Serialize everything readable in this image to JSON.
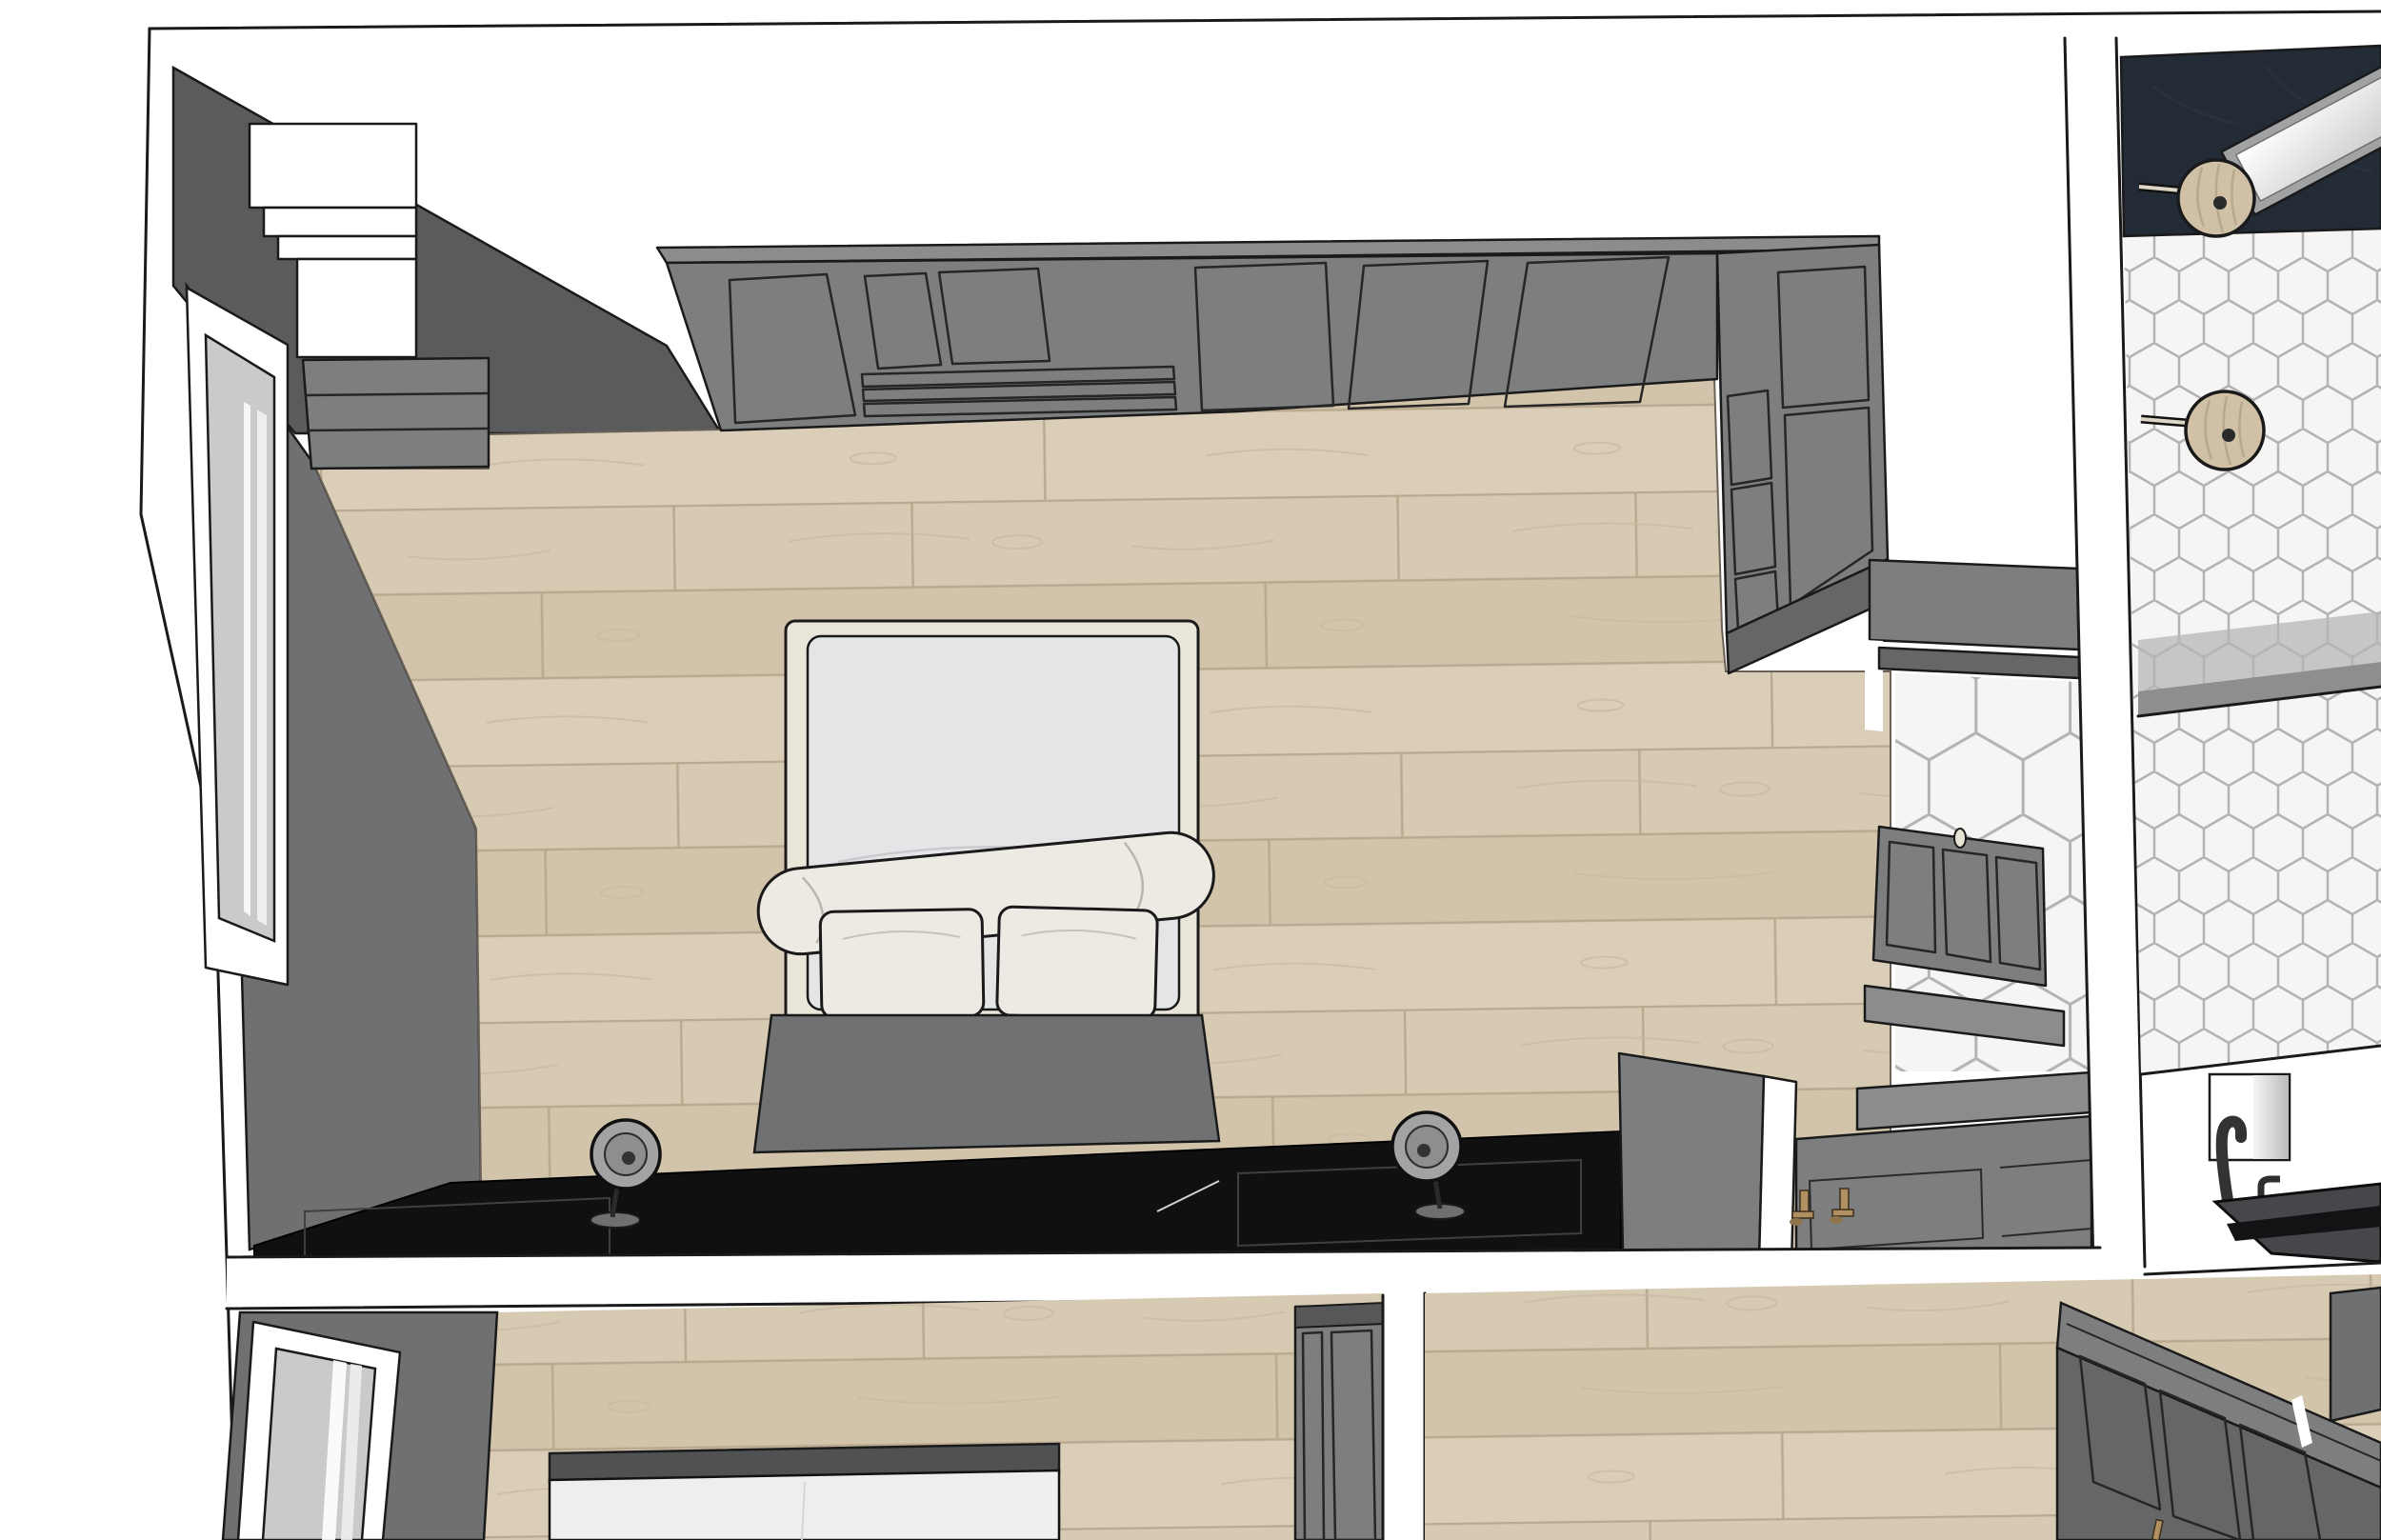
{
  "scene": {
    "kind": "3d-overhead-floorplan-render",
    "rooms": [
      {
        "name": "main-bedroom",
        "floor": "light-oak-planks",
        "elements": [
          "left-wall-with-window",
          "white-stepped-hutch",
          "corner-drawer-chest",
          "paneled-wardrobe-run",
          "corner-wardrobe-column",
          "double-bed-with-rolled-blanket",
          "pillow-count-2",
          "gray-headboard-platform",
          "black-console-nightstand",
          "table-lamp-count-2",
          "open-door-to-ensuite",
          "ensuite-vanity-cabinet",
          "partition-wall",
          "sink-counter-with-gold-faucets",
          "gold-faucet-count-2"
        ]
      },
      {
        "name": "ensuite-bathroom-strip",
        "floor": "white-hex-mosaic-tile",
        "elements": [
          "navy-vanity-wall",
          "leaning-mirror",
          "round-wood-sconce-count-2",
          "shower-threshold-band",
          "wall-niche",
          "dark-gooseneck-tub-filler",
          "small-faucet",
          "dark-basin"
        ]
      },
      {
        "name": "second-bedroom-bottom-left",
        "floor": "light-oak-planks",
        "elements": [
          "left-wall-with-window",
          "bed-partial",
          "gray-wardrobe-partial"
        ]
      },
      {
        "name": "room-bottom-right",
        "floor": "light-oak-planks",
        "elements": [
          "large-paneled-wardrobe",
          "brass-knob"
        ]
      }
    ]
  },
  "palette": {
    "paper": "#ffffff",
    "line": "#1a1a1a",
    "panel-line": "#262626",
    "wall-dark": "#595b5c",
    "wall-mid": "#6e7071",
    "cabinet": "#7c7e7f",
    "cabinet-light": "#8a8c8d",
    "cabinet-dark": "#646667",
    "console": "#101010",
    "navy": "#222b36",
    "bed-frame": "#eae5d9",
    "mattress": "#e4e5e7",
    "linen": "#eceae3",
    "headboard": "#6f7172",
    "glass": "#c9cacb",
    "plank-a": "#d7cab3",
    "plank-b": "#d2c4ab",
    "plank-c": "#dbceb9",
    "plank-seam": "#b9a98f",
    "hex-fill": "#f6f5f3",
    "hex-grout": "#b3b3b3",
    "brass": "#b08f60",
    "sconce-wood": "#cfc0a6",
    "mirror-frame": "#a0a2a3",
    "lamp-shade": "#a3a3a3",
    "basin": "#45474a"
  }
}
